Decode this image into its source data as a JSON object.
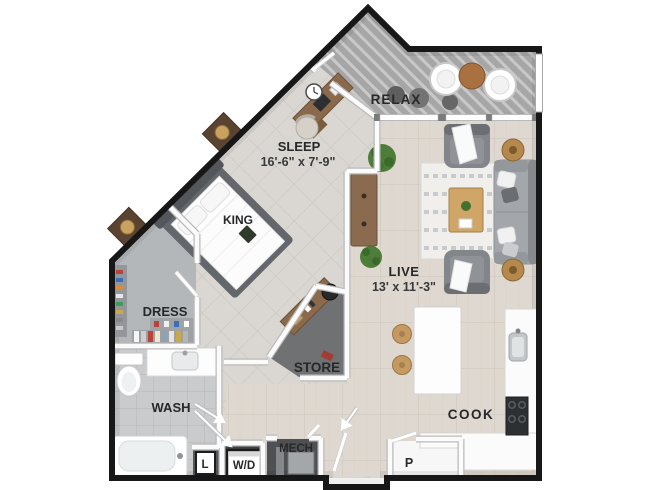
{
  "rooms": {
    "relax": {
      "label": "RELAX"
    },
    "sleep": {
      "label": "SLEEP",
      "dims": "16'-6\" x 7'-9\""
    },
    "bed": {
      "label": "KING"
    },
    "live": {
      "label": "LIVE",
      "dims": "13' x 11'-3\""
    },
    "dress": {
      "label": "DRESS"
    },
    "store": {
      "label": "STORE"
    },
    "wash": {
      "label": "WASH"
    },
    "linen": {
      "label": "L"
    },
    "laundry": {
      "label": "W/D"
    },
    "mech": {
      "label": "MECH"
    },
    "cook": {
      "label": "COOK"
    },
    "pantry": {
      "label": "P"
    }
  },
  "colors": {
    "outer_wall": "#171717",
    "deck": "#a6a6a6",
    "tile_floor": "#dad7d2",
    "wood_floor": "#ded8d0",
    "bath_floor": "#c9cbcd",
    "dress_floor": "#b4b7ba",
    "store_floor": "#6f7173",
    "mech_floor": "#4e5053",
    "laundry_floor": "#3f4144",
    "pantry_floor": "#f7f7f7",
    "label_text": "#26282a",
    "wood_accent": "#8a6a4a",
    "plant": "#4e7d3a"
  }
}
